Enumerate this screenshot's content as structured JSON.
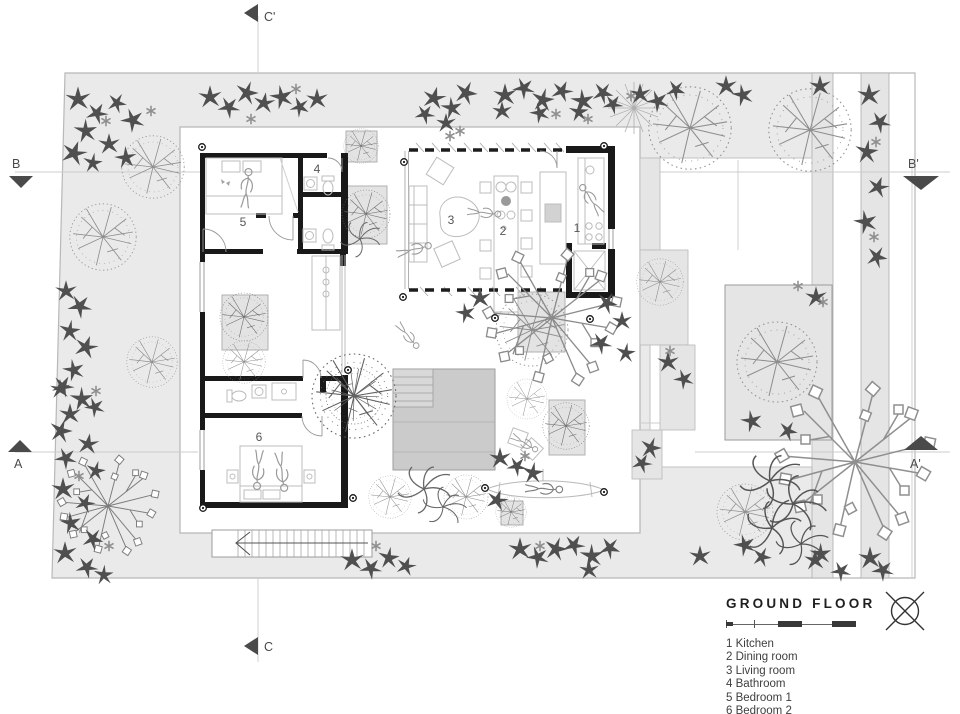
{
  "legend": {
    "title": "GROUND FLOOR",
    "north_icon": "north-compass-icon",
    "items": [
      "1 Kitchen",
      "2 Dining room",
      "3 Living room",
      "4 Bathroom",
      "5 Bedroom 1",
      "6 Bedroom 2"
    ]
  },
  "plan": {
    "room_numbers": {
      "kitchen": "1",
      "dining": "2",
      "living": "3",
      "bathroom": "4",
      "bedroom1": "5",
      "bedroom2": "6"
    },
    "sections": {
      "c_top": "C'",
      "b_left": "B",
      "b_right": "B'",
      "a_left": "A",
      "a_right": "A'",
      "c_bottom": "C"
    }
  },
  "colors": {
    "site_fill": "#eaeaea",
    "panel_fill": "#e5e5e5",
    "deck_fill": "#cbcbcb",
    "wall": "#191919",
    "tree_stroke": "#8d8d8d",
    "label_text": "#4a4a4a"
  }
}
